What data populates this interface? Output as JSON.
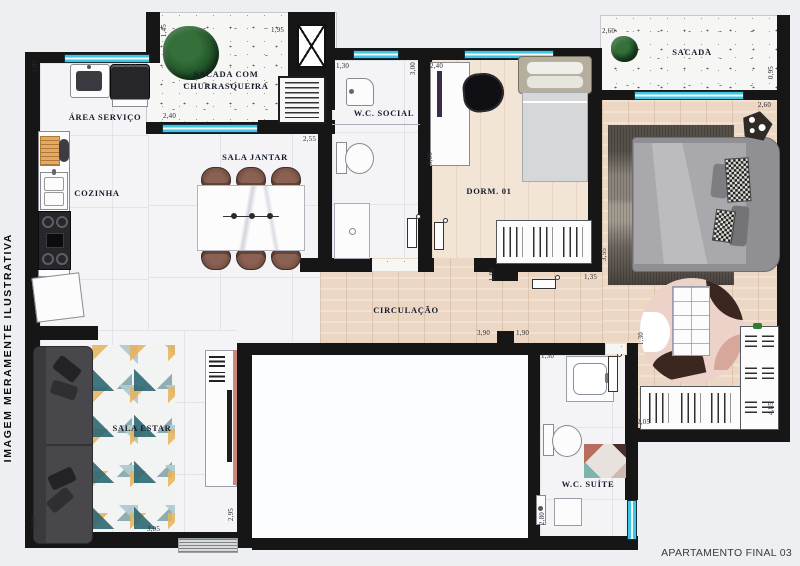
{
  "meta": {
    "watermark": "IMAGEM MERAMENTE ILUSTRATIVA",
    "footer": "APARTAMENTO FINAL 03"
  },
  "rooms": {
    "area_servico": "ÁREA SERVIÇO",
    "cozinha": "COZINHA",
    "sacada_churrasqueira_l1": "SACADA COM",
    "sacada_churrasqueira_l2": "CHURRASQUEIRA",
    "sala_jantar": "SALA JANTAR",
    "wc_social": "W.C. SOCIAL",
    "dorm_01": "DORM. 01",
    "sacada": "SACADA",
    "circulacao": "CIRCULAÇÃO",
    "sala_estar": "SALA ESTAR",
    "wc_suite": "W.C. SUÍTE"
  },
  "dimensions": [
    "3,95",
    "1,75",
    "1,45",
    "1,95",
    "2,40",
    "2,55",
    "1,30",
    "3,00",
    "2,40",
    "3,00",
    "2,60",
    "0,95",
    "2,60",
    "3,55",
    "1,35",
    "1,00",
    "3,90",
    "1,90",
    "1,30",
    "2,95",
    "3,05",
    "3,60",
    "2,05",
    "1,30",
    "4,85",
    "2,80"
  ],
  "colors": {
    "wall": "#161616",
    "window_glass": "#3fc4e2",
    "wood_floor": "#ebd7c3",
    "tile_floor": "#f4f4f7",
    "balcony_floor": "#f6f6f4",
    "rug_teal": "#2d6b77",
    "rug_mustard": "#e9b45b",
    "bed_gray": "#a9a9ad",
    "label_ink": "#141b2b"
  }
}
